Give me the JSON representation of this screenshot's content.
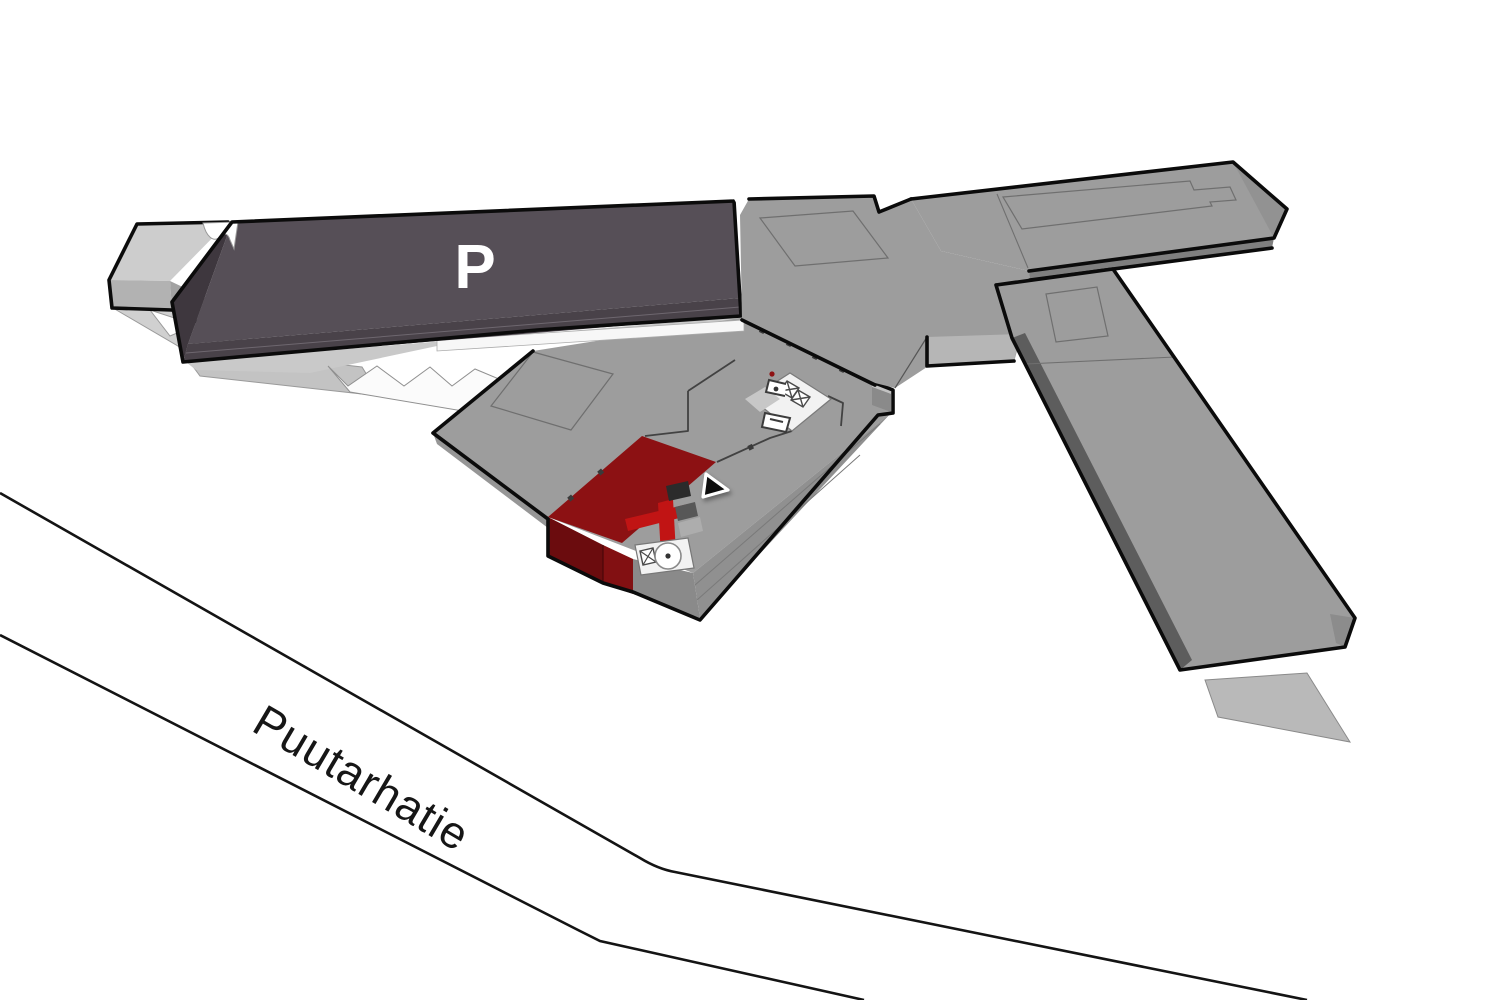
{
  "map": {
    "title": "3D mall wayfinding map",
    "parking_label": "P",
    "street_name": "Puutarhatie"
  },
  "colors": {
    "background": "#ffffff",
    "parking_deck_top": "#564f57",
    "parking_deck_front": "#494249",
    "parking_deck_side": "#3e373e",
    "roof_gray": "#9d9d9d",
    "roof_side_dark": "#5d5d5d",
    "roof_front": "#8f8f8f",
    "light_wing_top": "#cdcdcd",
    "ground_patch": "#cbcbcb",
    "highlight_red": "#8c1113",
    "highlight_red_bright": "#c11414",
    "highlight_red_front": "#6b0c0e",
    "street_line": "#141414",
    "marker_fill": "#0d0d0d",
    "marker_outline": "#ffffff",
    "interior_white": "#f2f2f2"
  },
  "marker": {
    "name": "location-arrow"
  }
}
